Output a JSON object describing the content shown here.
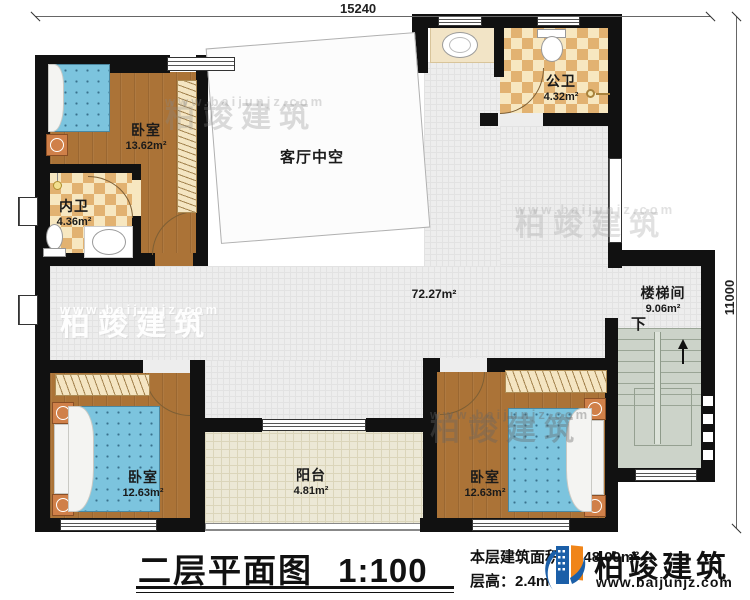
{
  "dimensions": {
    "top": "15240",
    "right": "11000"
  },
  "rooms": [
    {
      "id": "bedroom-top-left",
      "name": "卧室",
      "area": "13.62m²"
    },
    {
      "id": "inner-bath",
      "name": "内卫",
      "area": "4.36m²"
    },
    {
      "id": "living-void",
      "name": "客厅中空"
    },
    {
      "id": "public-bath",
      "name": "公卫",
      "area": "4.32m²"
    },
    {
      "id": "corridor",
      "area": "72.27m²"
    },
    {
      "id": "stairwell",
      "name": "楼梯间",
      "area": "9.06m²",
      "direction": "下"
    },
    {
      "id": "bedroom-bottom-left",
      "name": "卧室",
      "area": "12.63m²"
    },
    {
      "id": "balcony",
      "name": "阳台",
      "area": "4.81m²"
    },
    {
      "id": "bedroom-bottom-right",
      "name": "卧室",
      "area": "12.63m²"
    }
  ],
  "footer": {
    "title": "二层平面图",
    "scale": "1:100",
    "area_label": "本层建筑面积：",
    "area_value": "148.09m²",
    "floor_height_label": "层高：",
    "floor_height_value": "2.4m"
  },
  "brand": {
    "name": "柏竣建筑",
    "url": "www.baijunjz.com"
  },
  "watermark": {
    "name": "柏竣建筑",
    "url": "www.baijunjz.com"
  },
  "colors": {
    "wall": "#111111",
    "wood_floor": "#ab7337",
    "bath_checker": "#e2b271",
    "corridor_tile": "#ededed",
    "stairs": "#ccd3c9",
    "mattress": "#7cc4de",
    "logo_blue": "#1b5fa8",
    "logo_orange": "#f08519"
  }
}
